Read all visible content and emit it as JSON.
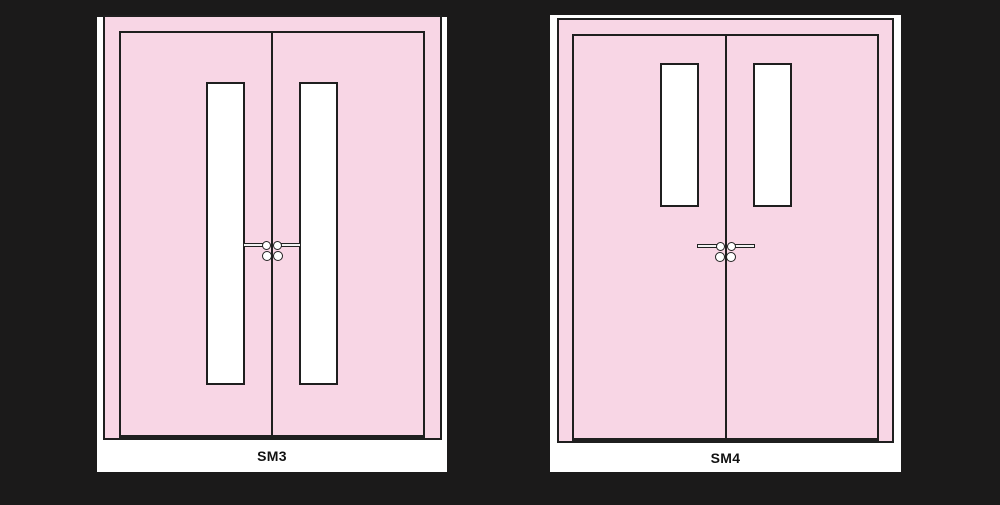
{
  "canvas": {
    "background": "#1b1a1a"
  },
  "colors": {
    "canvas-bg": "#1b1a1a",
    "panel": "#f8d6e5",
    "outline": "#1f1f1f",
    "surround": "#ffffff",
    "glass": "#ffffff"
  },
  "doors": [
    {
      "label": "SM3"
    },
    {
      "label": "SM4"
    }
  ]
}
